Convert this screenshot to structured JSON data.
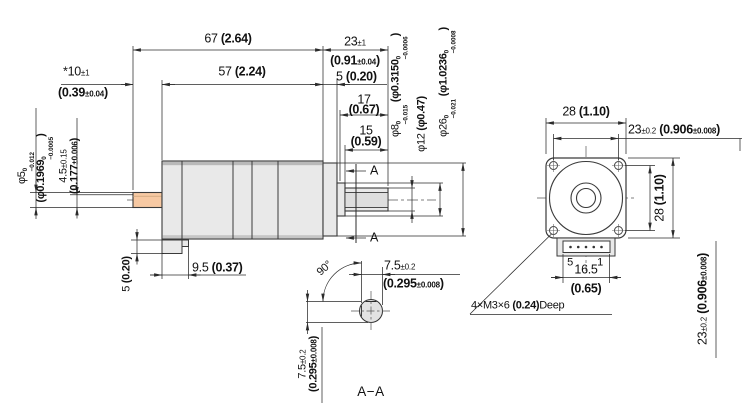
{
  "drawing": {
    "type": "mechanical-dimension-drawing",
    "views": [
      "side-view",
      "section-A-A",
      "front-view"
    ]
  },
  "colors": {
    "line": "#2b2b2b",
    "body_fill": "#e9e9e9",
    "rear_shaft_fill": "#f7c9a3",
    "section_fill": "#e2e2e2"
  },
  "side_view": {
    "overall_len": {
      "mm": "67 ",
      "inch": "(2.64)"
    },
    "shaft_len": {
      "mm": "23",
      "tol": "±1",
      "inch_open": "(0.91",
      "inch_tol": "±0.04",
      "inch_close": ")"
    },
    "body_len": {
      "mm": "57 ",
      "inch": "(2.24)"
    },
    "rear_shaft_len": {
      "mm": "*10",
      "tol": "±1",
      "inch_open": "(0.39",
      "inch_tol": "±0.04",
      "inch_close": ")"
    },
    "pilot_len": {
      "mm": "5 ",
      "inch": "(0.20)"
    },
    "shaft_step_len": {
      "mm": "17",
      "inch": "(0.67)"
    },
    "flat_len": {
      "mm": "15",
      "inch": "(0.59)"
    },
    "dia8": {
      "mm": "φ8",
      "tol_hi": "0",
      "tol_lo": "−0.015",
      "inch_open": " (φ0.3150",
      "itol_hi": "0",
      "itol_lo": "−0.0006",
      "inch_close": ")"
    },
    "dia12": {
      "mm": "φ12 ",
      "inch": "(φ0.47)"
    },
    "dia26": {
      "mm": "φ26",
      "tol_hi": "0",
      "tol_lo": "−0.021",
      "inch_open": " (φ1.0236",
      "itol_hi": "0",
      "itol_lo": "−0.0008",
      "inch_close": ")"
    },
    "rear_dia5": {
      "mm": "φ5",
      "tol_hi": "0",
      "tol_lo": "−0.012",
      "inch_open": "(φ0.1969",
      "itol_hi": "0",
      "itol_lo": "−0.0005",
      "inch_close": ")"
    },
    "rear_flat": {
      "mm": "4.5",
      "tol": "±0.15",
      "inch_open": "(0.177",
      "inch_tol": "±0.006",
      "inch_close": ")"
    },
    "tab_height": {
      "mm": "5 ",
      "inch": "(0.20)"
    },
    "tab_len": {
      "mm": "9.5 ",
      "inch": "(0.37)"
    },
    "section_marker": "A"
  },
  "section_view": {
    "title": "A−A",
    "angle": "90°",
    "flat": {
      "mm": "7.5",
      "tol": "±0.2",
      "inch_open": "(0.295",
      "inch_tol": "±0.008",
      "inch_close": ")"
    }
  },
  "front_view": {
    "width": {
      "mm": "28 ",
      "inch": "(1.10)"
    },
    "hole_spacing": {
      "mm": "23",
      "tol": "±0.2",
      "inch_open": " (0.906",
      "inch_tol": "±0.008",
      "inch_close": ")"
    },
    "pin_left": "5",
    "pin_right": "1",
    "connector_width": {
      "mm": "16.5",
      "inch": "(0.65)"
    },
    "thread_note": {
      "prefix": "4×M3×6 ",
      "inch": "(0.24)",
      "suffix": "Deep"
    }
  }
}
